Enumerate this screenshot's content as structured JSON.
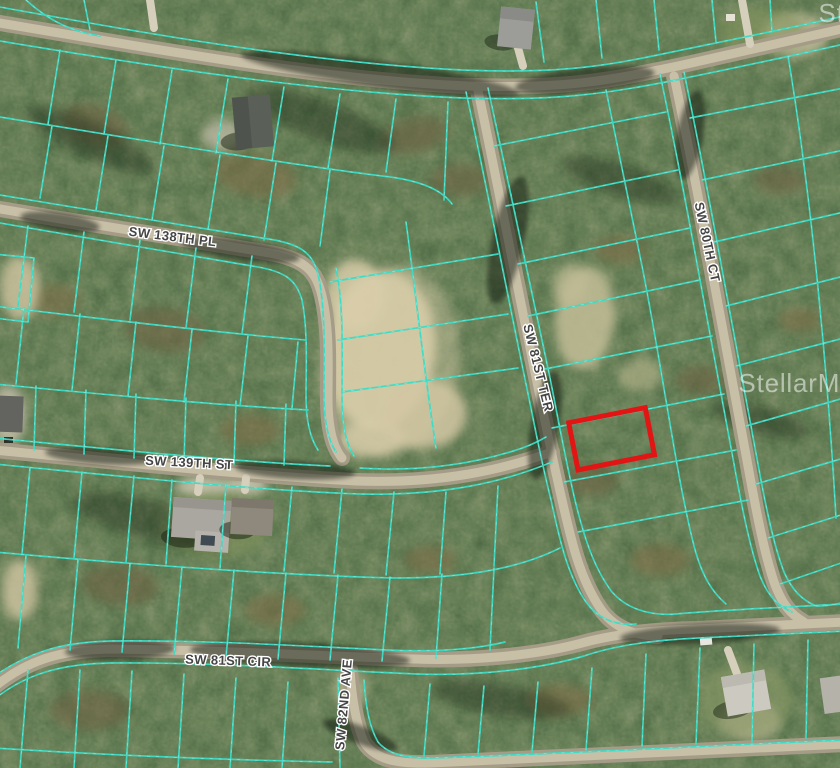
{
  "map": {
    "street_labels": [
      {
        "id": "sw-138th-pl",
        "text": "SW 138TH PL"
      },
      {
        "id": "sw-139th-st",
        "text": "SW 139TH ST"
      },
      {
        "id": "sw-81st-cir",
        "text": "SW 81ST CIR"
      },
      {
        "id": "sw-82nd-ave",
        "text": "SW 82ND AVE"
      },
      {
        "id": "sw-81st-ter",
        "text": "SW 81ST TER"
      },
      {
        "id": "sw-80th-ct",
        "text": "SW 80TH CT"
      }
    ],
    "watermark": {
      "text": "StellarMLS"
    },
    "highlight": {
      "color": "#e31414"
    },
    "colors": {
      "parcel_line": "#3bdcc6",
      "road": "#b4ab95",
      "sand": "#d8cca9"
    }
  }
}
